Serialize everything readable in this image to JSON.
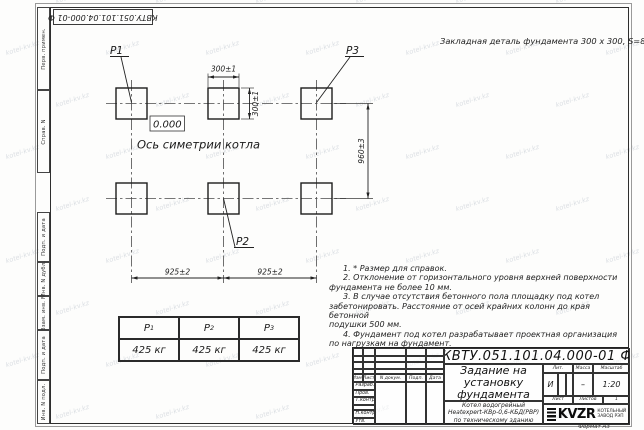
{
  "watermark": {
    "text": "kotel-kv.kz"
  },
  "corner_stamp": "КВТУ.051.101.04.000-01  Ф",
  "side_column": {
    "boxes": [
      "Перв. примен.",
      "Справ. N",
      "Подп. и дата",
      "Инв. N дубл.",
      "Взам. инв. N",
      "Подп. и дата",
      "Инв. N подл."
    ]
  },
  "annotation_top_right": "Закладная деталь фундамента  300 х 300,  S=8;",
  "drawing": {
    "labels": {
      "p1": "P1",
      "p2": "P2",
      "p3": "P3"
    },
    "elevation": "0.000",
    "axis_caption": "Ось симетрии котла",
    "dims": {
      "pad_width": "300±1",
      "pad_height": "300±1",
      "span_left": "925±2",
      "span_right": "925±2",
      "span_vertical": "960±3"
    }
  },
  "notes": {
    "lines": [
      "1. * Размер для справок.",
      "2. Отклонение от горизонтального уровня верхней поверхности",
      "фундамента не более 10 мм.",
      "3. В случае отсутствия бетонного пола площадку под котел",
      "забетонировать. Расстояние от осей крайних колонн до края бетонной",
      "подушки 500 мм.",
      "4. Фундамент под котел разрабатывает проектная организация",
      "по нагрузкам на фундамент."
    ]
  },
  "load_table": {
    "columns": [
      {
        "base": "P",
        "sub": "1"
      },
      {
        "base": "P",
        "sub": "2"
      },
      {
        "base": "P",
        "sub": "3"
      }
    ],
    "values": [
      "425 кг",
      "425 кг",
      "425 кг"
    ]
  },
  "title_block": {
    "doc_number": "КВТУ.051.101.04.000-01  Ф",
    "title_lines": [
      "Задание на",
      "установку",
      "фундамента"
    ],
    "subtitle_lines": [
      "Котел водогрейный",
      "Heatexpert-КВр-0,6-КБД(РВР)",
      "по техническому зданию"
    ],
    "header_cols": [
      "Изм.",
      "Лист",
      "N докум.",
      "Подп.",
      "Дата"
    ],
    "row_labels": [
      "Разраб.",
      "Пров.",
      "Т.контр.",
      "Н.контр.",
      "Утв."
    ],
    "lit_label": "Лит.",
    "mass_label": "Масса",
    "scale_label": "Масштаб",
    "lit_value": "И",
    "mass_value": "–",
    "scale_value": "1:20",
    "sheet_label": "Лист",
    "sheets_label": "Листов",
    "sheets_value": "1",
    "logo_text": "KVZR",
    "logo_caption_lines": [
      "КОТЕЛЬНЫЙ",
      "ЗАВОД РЭП"
    ],
    "format_label": "Формат А3"
  }
}
